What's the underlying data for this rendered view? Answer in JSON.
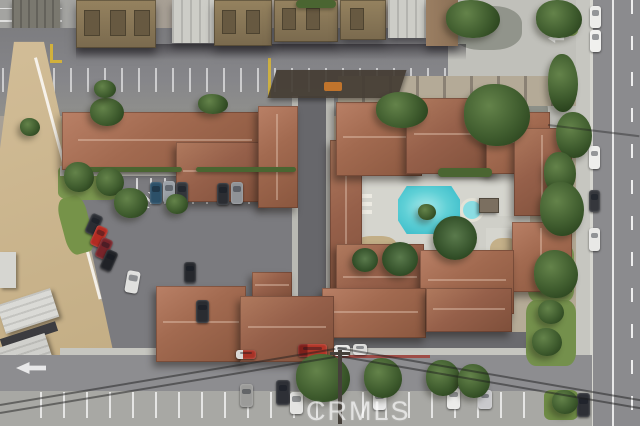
{
  "watermark": {
    "text": "CRMLS"
  },
  "scene": {
    "kind": "aerial-photo-of-condo-complex",
    "palette": {
      "roof_terracotta": "#a26a50",
      "roof_brown": "#85745a",
      "asphalt_street": "#8b8b8e",
      "asphalt_parking": "#7b7b7f",
      "concrete": "#cfcfc8",
      "dirt": "#c9b28c",
      "grass": "#7b9750",
      "tree_canopy": "#3f5c2e",
      "pool_water": "#3cc2d2",
      "pool_deck": "#d5d5ce",
      "lane_marking": "#ffffff",
      "yellow_curb": "#d2b13c"
    },
    "objects": {
      "trees": [
        {
          "x": 90,
          "y": 98,
          "w": 34,
          "h": 28
        },
        {
          "x": 198,
          "y": 94,
          "w": 30,
          "h": 20
        },
        {
          "x": 94,
          "y": 80,
          "w": 22,
          "h": 18
        },
        {
          "x": 64,
          "y": 162,
          "w": 30,
          "h": 30
        },
        {
          "x": 96,
          "y": 168,
          "w": 28,
          "h": 28
        },
        {
          "x": 114,
          "y": 188,
          "w": 34,
          "h": 30
        },
        {
          "x": 166,
          "y": 194,
          "w": 22,
          "h": 20
        },
        {
          "x": 446,
          "y": 0,
          "w": 54,
          "h": 38
        },
        {
          "x": 536,
          "y": 0,
          "w": 46,
          "h": 38
        },
        {
          "x": 464,
          "y": 84,
          "w": 66,
          "h": 62
        },
        {
          "x": 376,
          "y": 92,
          "w": 52,
          "h": 36
        },
        {
          "x": 548,
          "y": 54,
          "w": 30,
          "h": 58
        },
        {
          "x": 556,
          "y": 112,
          "w": 36,
          "h": 46
        },
        {
          "x": 544,
          "y": 152,
          "w": 32,
          "h": 42
        },
        {
          "x": 540,
          "y": 182,
          "w": 44,
          "h": 54
        },
        {
          "x": 534,
          "y": 250,
          "w": 44,
          "h": 48
        },
        {
          "x": 538,
          "y": 300,
          "w": 26,
          "h": 24
        },
        {
          "x": 532,
          "y": 328,
          "w": 30,
          "h": 28
        },
        {
          "x": 418,
          "y": 204,
          "w": 18,
          "h": 16
        },
        {
          "x": 296,
          "y": 354,
          "w": 54,
          "h": 48
        },
        {
          "x": 364,
          "y": 358,
          "w": 38,
          "h": 40
        },
        {
          "x": 426,
          "y": 360,
          "w": 34,
          "h": 36
        },
        {
          "x": 458,
          "y": 364,
          "w": 32,
          "h": 34
        },
        {
          "x": 552,
          "y": 390,
          "w": 26,
          "h": 24
        },
        {
          "x": 20,
          "y": 118,
          "w": 20,
          "h": 18
        }
      ],
      "palms": [
        {
          "x": 433,
          "y": 216,
          "w": 44,
          "h": 44
        },
        {
          "x": 382,
          "y": 242,
          "w": 36,
          "h": 34
        },
        {
          "x": 352,
          "y": 248,
          "w": 26,
          "h": 24
        }
      ],
      "hedges": [
        {
          "x": 66,
          "y": 167,
          "w": 116,
          "h": 5
        },
        {
          "x": 196,
          "y": 167,
          "w": 100,
          "h": 5
        },
        {
          "x": 438,
          "y": 168,
          "w": 54,
          "h": 9
        },
        {
          "x": 296,
          "y": 0,
          "w": 40,
          "h": 8
        }
      ],
      "cars": [
        {
          "x": 150,
          "y": 182,
          "w": 12,
          "h": 22,
          "color": "#2c5068"
        },
        {
          "x": 163,
          "y": 181,
          "w": 12,
          "h": 22,
          "color": "#9aa0a6"
        },
        {
          "x": 176,
          "y": 182,
          "w": 12,
          "h": 22,
          "color": "#33363b"
        },
        {
          "x": 217,
          "y": 183,
          "w": 12,
          "h": 22,
          "color": "#2b2d32"
        },
        {
          "x": 231,
          "y": 182,
          "w": 12,
          "h": 22,
          "color": "#8f9296"
        },
        {
          "x": 88,
          "y": 214,
          "w": 12,
          "h": 21,
          "color": "#2a2d33",
          "rot": 24
        },
        {
          "x": 93,
          "y": 226,
          "w": 12,
          "h": 21,
          "color": "#b32b22",
          "rot": 24
        },
        {
          "x": 98,
          "y": 238,
          "w": 12,
          "h": 21,
          "color": "#77242a",
          "rot": 24
        },
        {
          "x": 103,
          "y": 250,
          "w": 12,
          "h": 21,
          "color": "#202227",
          "rot": 24
        },
        {
          "x": 126,
          "y": 271,
          "w": 13,
          "h": 22,
          "color": "#e0e0de",
          "rot": 10
        },
        {
          "x": 184,
          "y": 262,
          "w": 12,
          "h": 21,
          "color": "#26282d"
        },
        {
          "x": 196,
          "y": 300,
          "w": 13,
          "h": 23,
          "color": "#2a2c31"
        },
        {
          "x": 590,
          "y": 6,
          "w": 11,
          "h": 22,
          "color": "#ececea"
        },
        {
          "x": 590,
          "y": 30,
          "w": 11,
          "h": 22,
          "color": "#f0f0ee"
        },
        {
          "x": 589,
          "y": 146,
          "w": 11,
          "h": 23,
          "color": "#eeeeec"
        },
        {
          "x": 589,
          "y": 190,
          "w": 11,
          "h": 22,
          "color": "#35373c"
        },
        {
          "x": 589,
          "y": 228,
          "w": 11,
          "h": 23,
          "color": "#e8e8e6"
        },
        {
          "x": 577,
          "y": 393,
          "w": 13,
          "h": 24,
          "color": "#2e3036"
        },
        {
          "x": 298,
          "y": 344,
          "w": 29,
          "h": 13,
          "color": "linear-gradient(90deg,#7e1f1a 32%,#b23527 32%)",
          "name": "red-pickup-truck"
        },
        {
          "x": 236,
          "y": 350,
          "w": 20,
          "h": 9,
          "color": "linear-gradient(90deg,#d8d8d6 35%,#a83226 35%)"
        },
        {
          "x": 334,
          "y": 345,
          "w": 16,
          "h": 11,
          "color": "#e9e9e7"
        },
        {
          "x": 353,
          "y": 344,
          "w": 14,
          "h": 11,
          "color": "#dcdcda"
        },
        {
          "x": 240,
          "y": 384,
          "w": 13,
          "h": 23,
          "color": "#9b9b99"
        },
        {
          "x": 276,
          "y": 380,
          "w": 14,
          "h": 25,
          "color": "#2e3036"
        },
        {
          "x": 290,
          "y": 392,
          "w": 13,
          "h": 22,
          "color": "#e4e4e2"
        },
        {
          "x": 373,
          "y": 390,
          "w": 13,
          "h": 20,
          "color": "#e8e8e8"
        },
        {
          "x": 447,
          "y": 388,
          "w": 13,
          "h": 21,
          "color": "#ececea"
        },
        {
          "x": 478,
          "y": 390,
          "w": 14,
          "h": 19,
          "color": "#c9c9cc"
        }
      ]
    }
  }
}
